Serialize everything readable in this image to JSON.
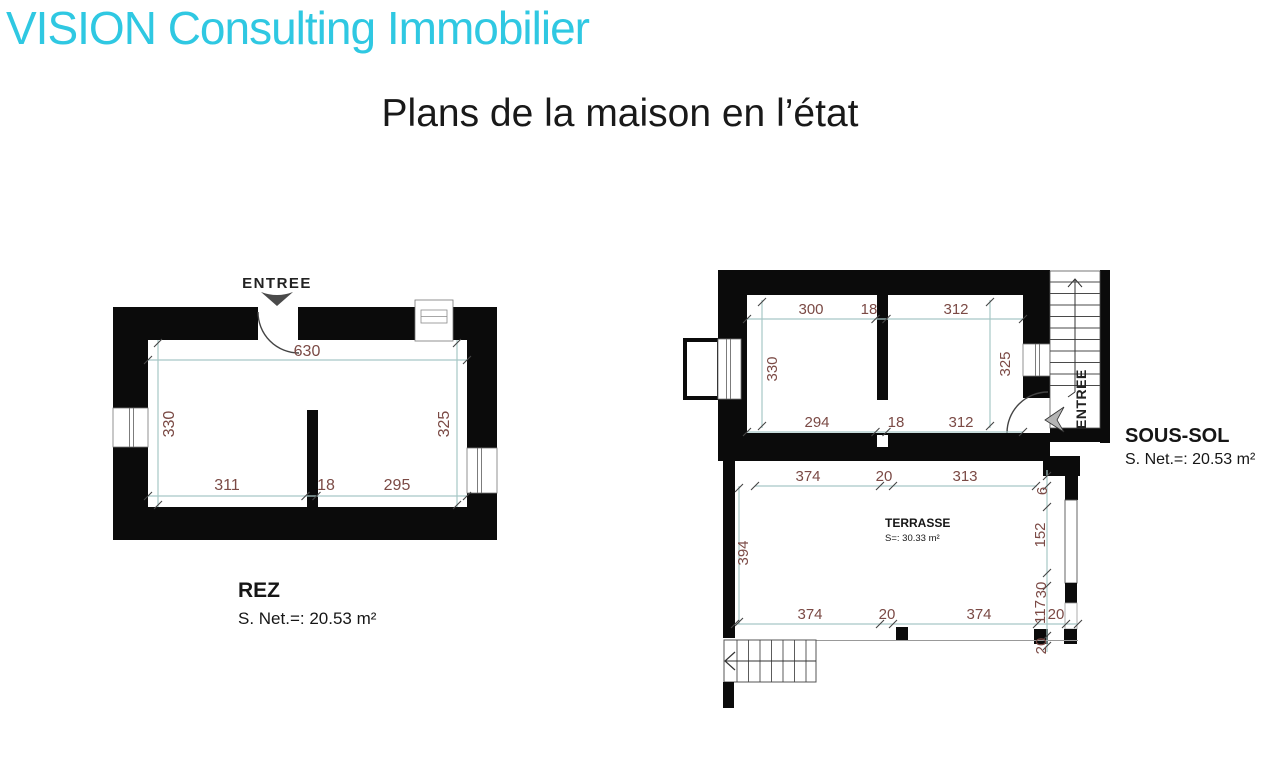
{
  "header": {
    "brand": "VISION Consulting Immobilier",
    "title": "Plans de la maison en l’état"
  },
  "colors": {
    "brand_cyan": "#2fc8e2",
    "wall_black": "#0b0b0b",
    "dim_line_teal": "#a6c7c6",
    "dim_text_maroon": "#7b4a45"
  },
  "rez": {
    "entry_label": "ENTREE",
    "dim_top": "630",
    "dim_left": "330",
    "dim_right": "325",
    "dim_bottom": [
      "311",
      "18",
      "295"
    ],
    "name": "REZ",
    "area": "S. Net.=: 20.53 m²"
  },
  "soussol": {
    "name": "SOUS-SOL",
    "area": "S. Net.=: 20.53 m²",
    "entry_label": "ENTREE",
    "room": {
      "dim_top": [
        "300",
        "18",
        "312"
      ],
      "dim_bottom": [
        "294",
        "18",
        "312"
      ],
      "dim_left": "330",
      "dim_right": "325"
    },
    "terrasse": {
      "label": "TERRASSE",
      "area": "S=: 30.33 m²",
      "dim_top": [
        "374",
        "20",
        "313"
      ],
      "dim_bottom": [
        "374",
        "20",
        "374",
        "20"
      ],
      "dim_left": "394",
      "dim_right": [
        "6",
        "152",
        "30",
        "117",
        "20"
      ]
    }
  }
}
